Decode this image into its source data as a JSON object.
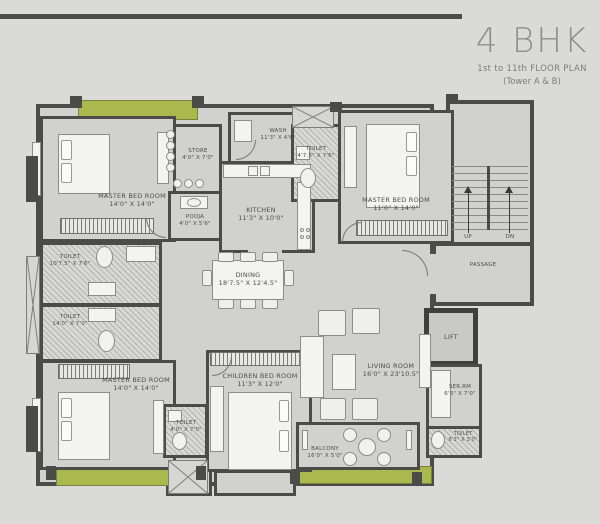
{
  "header": {
    "title": "4 BHK",
    "subtitle": "1st to 11th FLOOR PLAN",
    "tower": "(Tower A & B)"
  },
  "colors": {
    "background": "#dadad9",
    "wall": "#4b4b49",
    "floor": "#d1d1cf",
    "balcony_green": "#aab94e",
    "title_text": "#8f8f8e"
  },
  "rooms": {
    "master_tl": {
      "name": "MASTER BED ROOM",
      "dims": "14'0\" X 14'0\""
    },
    "store": {
      "name": "STORE",
      "dims": "4'0\" X 7'0\""
    },
    "pooja": {
      "name": "POOJA",
      "dims": "4'0\" X 5'6\""
    },
    "wash": {
      "name": "WASH",
      "dims": "11'3\" X 4'6\""
    },
    "kitchen": {
      "name": "KITCHEN",
      "dims": "11'3\" X 10'0\""
    },
    "toilet_top": {
      "name": "TOILET",
      "dims": "4'7.5\" X 7'6\""
    },
    "master_tr": {
      "name": "MASTER BED ROOM",
      "dims": "11'0\" X 14'0\""
    },
    "toilet_left_upper": {
      "name": "TOILET",
      "dims": "10'7.5\" X 7'6\""
    },
    "toilet_left_lower": {
      "name": "TOILET",
      "dims": "14'0\" X 7'0\""
    },
    "dining": {
      "name": "DINING",
      "dims": "18'7.5\" X 12'4.5\""
    },
    "master_bl": {
      "name": "MASTER BED ROOM",
      "dims": "14'0\" X 14'0\""
    },
    "toilet_bottom": {
      "name": "TOILET",
      "dims": "4'0\" X 7'0\""
    },
    "children": {
      "name": "CHILDREN BED ROOM",
      "dims": "11'3\" X 12'0\""
    },
    "living": {
      "name": "LIVING ROOM",
      "dims": "16'0\" X 23'10.5\""
    },
    "balcony": {
      "name": "BALCONY",
      "dims": "16'0\" X 5'0\""
    },
    "toilet_br": {
      "name": "TOILET",
      "dims": "6'3\" X 3'0\""
    },
    "servant": {
      "name": "SER.RM",
      "dims": "6'3\" X 7'0\""
    },
    "lift": {
      "name": "LIFT"
    },
    "passage": {
      "name": "PASSAGE"
    },
    "stairs": {
      "up": "UP",
      "dn": "DN"
    }
  }
}
